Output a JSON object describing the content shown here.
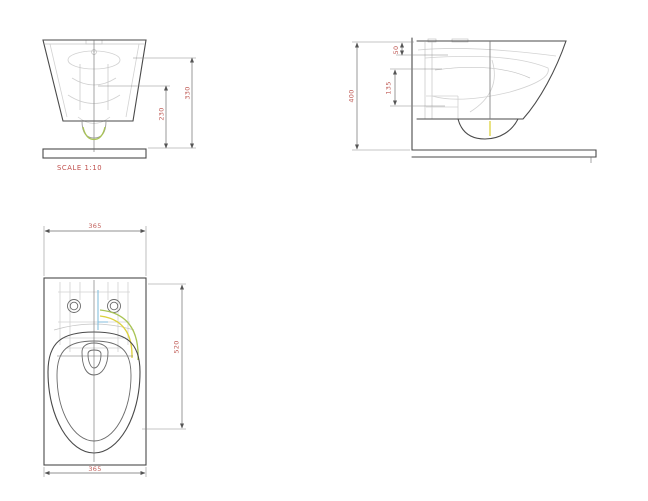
{
  "drawing": {
    "scale_note": "SCALE 1:10",
    "colors": {
      "background": "#ffffff",
      "outline": "#4a4a4a",
      "hidden_line": "#d2d2d2",
      "dimension_line": "#6e6e6e",
      "dimension_text": "#c2615c",
      "scale_text": "#c0504d",
      "accent_green": "#a9c455",
      "accent_yellow": "#ddd23e",
      "accent_blue": "#85bedd"
    },
    "views": {
      "front": {
        "dims": {
          "height_outer": "330",
          "height_inner": "230"
        }
      },
      "side": {
        "dims": {
          "overall_height": "400",
          "top_offset": "50",
          "mid_span": "135"
        }
      },
      "plan": {
        "dims": {
          "width_top": "365",
          "depth": "520",
          "width_bottom": "365"
        }
      }
    }
  }
}
